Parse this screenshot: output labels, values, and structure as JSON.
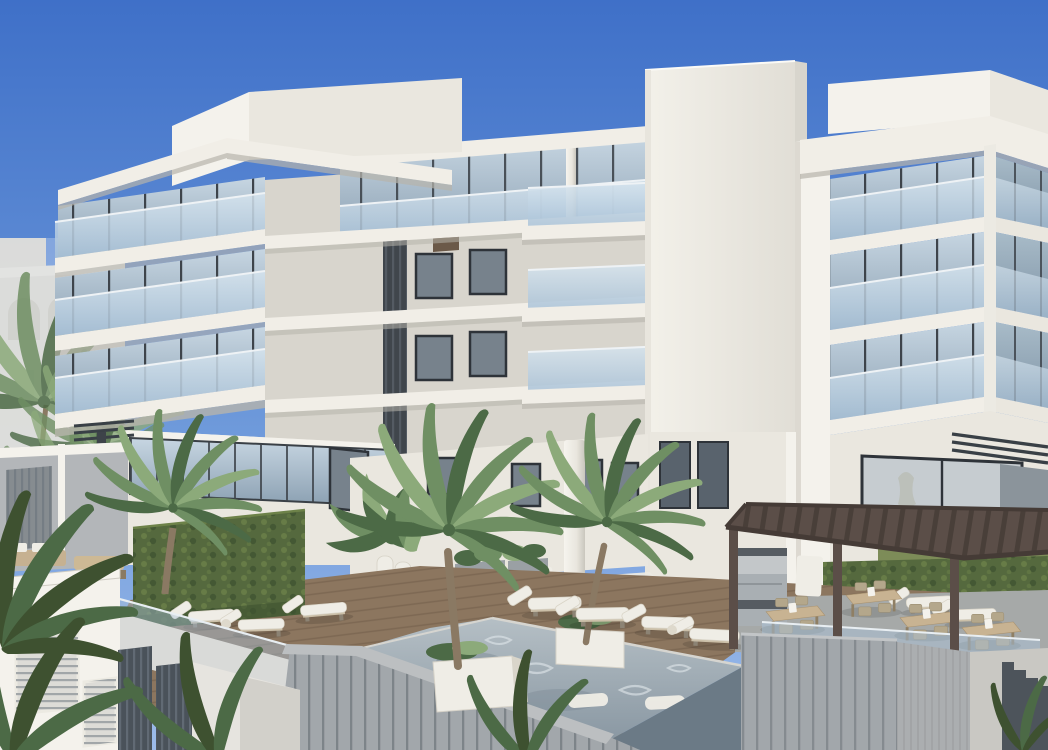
{
  "scene": {
    "title": "Architectural rendering of a modern white condominium with pool deck",
    "description": "Rendering of a modern white multi-story condominium under a clear blue sky: two wings of glass-balcony apartments flank a central white core tower; below is a courtyard pool deck with hardwood decking, white chaise lounges, palm trees in white planters, a raised board-formed concrete pool with in-water loungers, clipped hedge walls, and a dark timber pergola sheltering outdoor dining tables; a faded Mediterranean building appears at the far left horizon",
    "elements": {
      "sky": "clear blue sky",
      "left_wing": "four-level wing with glass curtain walls, glass balcony railings and cantilevered white slabs",
      "central_tower": "white central core tower",
      "right_wing": "four-level wing with wrap-around corner glass balconies",
      "courtyard": "ground-floor courtyard with dark-framed entries, round column and planters",
      "pool": "raised concrete pool with rippled water and two submerged white loungers",
      "deck": "hardwood pool deck with white chaise lounges",
      "pergola": "dark timber pergola over outdoor dining terrace with barbecue grill",
      "hedges": "clipped green hedge walls",
      "palms": "tropical palm trees and tropical foreground foliage",
      "background": "pale Mediterranean-style building with arched openings at left"
    },
    "counts": {
      "visible_floors_left_wing": 4,
      "visible_floors_right_wing": 4,
      "palm_trees": 3,
      "chaise_lounges": 9,
      "pool_loungers": 2,
      "dining_sets": 4
    }
  },
  "colors": {
    "sky_top": "#3f70c8",
    "sky_mid": "#6c98da",
    "sky_low": "#9cbbea",
    "wall_bright": "#f4f2ec",
    "wall_light": "#eae7df",
    "wall_shade": "#d8d5cd",
    "wall_dark": "#c5c2b9",
    "slab_face": "#f1eee7",
    "slab_shadow": "#b7b4ab",
    "glass_light": "#c7d6e2",
    "glass_dark": "#8ba0b2",
    "mullion": "#3e444b",
    "rail_glass": "#a9c2d8",
    "rail_light": "#d6e4ee",
    "frame_dark": "#2e3339",
    "louver_dark": "#40464c",
    "court_window": "#77828c",
    "hedge": "#55693e",
    "hedge_light": "#6d8249",
    "hedge_dark": "#3e5130",
    "grass": "#7d8c58",
    "palm_green": "#6f8f63",
    "palm_dark": "#4c6a46",
    "palm_light": "#8caa7a",
    "palm_faded": "#c6ccc5",
    "trunk": "#8a7963",
    "deck_wood": "#8c765f",
    "deck_plank_line": "#5f4d3b",
    "deck_pale": "#eceae3",
    "pool_water_back": "#b5bfc5",
    "pool_water_front": "#8a98a3",
    "pool_water_dark": "#76848f",
    "caustic": "#dde4e8",
    "pool_wall": "#a2a7ab",
    "pool_wall_dark": "#83898e",
    "pool_slat": "#6e747a",
    "concrete": "#969ca1",
    "concrete_light": "#c9c8c3",
    "pergola": "#5b4e48",
    "pergola_dark": "#453b36",
    "table_wood": "#c8b392",
    "chair_wood": "#b4a78b",
    "white_furn": "#efede6",
    "steel": "#a9afb3",
    "steel_dark": "#565c62",
    "step_dark": "#4d545b",
    "bg_build": "#ddd8cd",
    "bg_build_shade": "#cbc5b8",
    "canopy_dark": "#394046",
    "tower_light": "#f3f1ea",
    "tower_dim": "#e1ded6"
  }
}
